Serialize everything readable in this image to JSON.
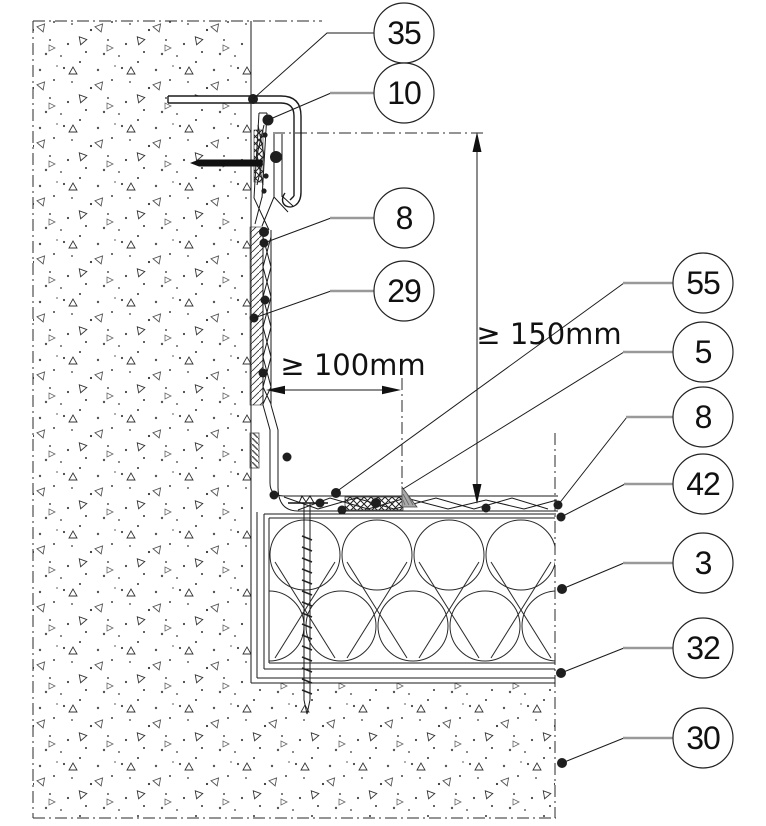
{
  "drawing": {
    "type": "construction-detail-section",
    "description": "Wall-to-flat-roof waterproofing junction detail with numbered component callouts",
    "dimensions": {
      "horizontal_min": "≥ 100mm",
      "vertical_min": "≥ 150mm"
    },
    "callouts": [
      {
        "number": "35"
      },
      {
        "number": "10"
      },
      {
        "number": "8"
      },
      {
        "number": "29"
      },
      {
        "number": "55"
      },
      {
        "number": "5"
      },
      {
        "number": "8"
      },
      {
        "number": "42"
      },
      {
        "number": "3"
      },
      {
        "number": "32"
      },
      {
        "number": "30"
      }
    ],
    "colors": {
      "line": "#1a1a1a",
      "leader_gray": "#999999",
      "sealant_gray": "#a9a9a9",
      "paper": "#ffffff"
    }
  }
}
